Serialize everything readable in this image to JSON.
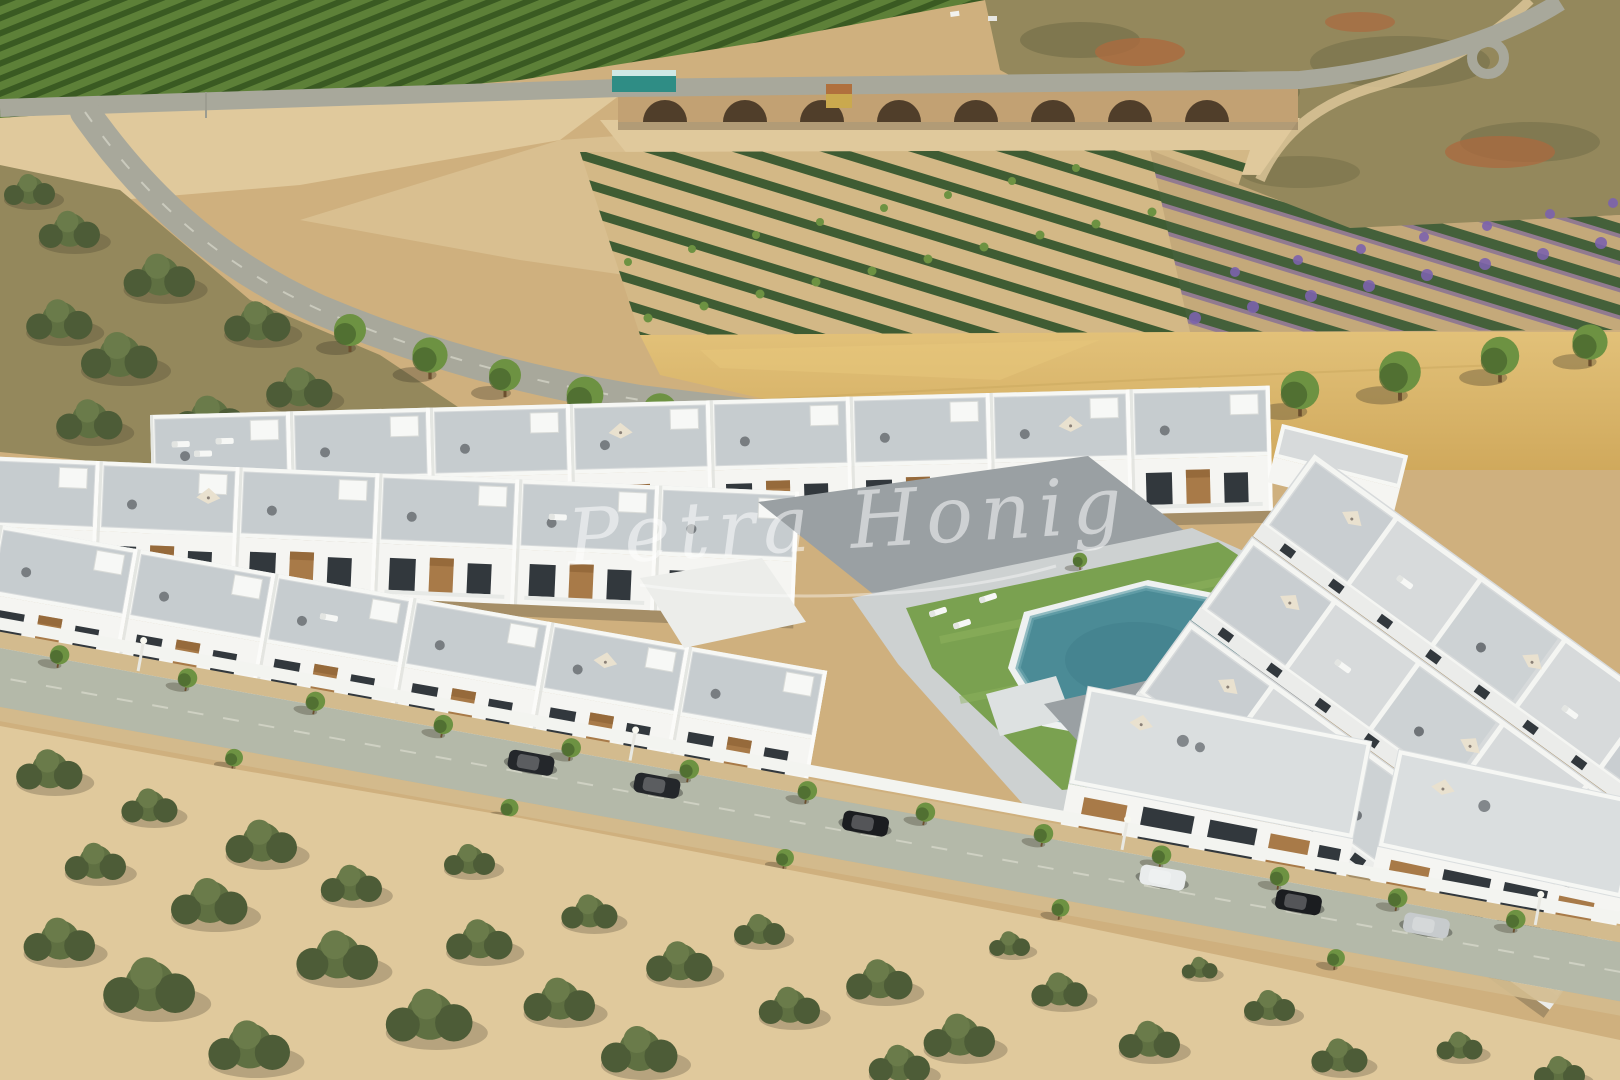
{
  "watermark": {
    "text": "Petra Honig",
    "color": "#ffffff",
    "opacity": 0.52
  },
  "palette": {
    "sand": "#cfb07e",
    "sandLight": "#e0c99c",
    "fieldGold": "#d9b469",
    "orchard": "#5d8038",
    "orchardDark": "#3a5a22",
    "scrub": "#94885c",
    "scrubDark": "#6e6a45",
    "redDirt": "#ab6a3f",
    "bushDark": "#4d5c37",
    "bushMid": "#5f7042",
    "treeGreen": "#6d9242",
    "treeDark": "#46632c",
    "road": "#a8a89b",
    "streetRoad": "#b4b9a9",
    "sidewalk": "#d3bb8e",
    "bridgeStone": "#c2a173",
    "archDark": "#503e2a",
    "plantGreen": "#3f5c33",
    "purple": "#7c63ad",
    "white": "#f5f5f2",
    "roofGray": "#d7dadb",
    "roofFloor": "#c6cccf",
    "pavingDark": "#9aa0a3",
    "wood": "#a87a48",
    "windowDark": "#32383d",
    "pool": "#4b8b96",
    "poolLight": "#6aa4ad",
    "lawn": "#7aa150",
    "lawnLight": "#8fb45e",
    "carDark": "#24272b",
    "carBlack": "#1b1d20",
    "carWhite": "#e9ecec",
    "carSilver": "#c7cbcd"
  },
  "scene": {
    "type": "aerial-architectural-render",
    "regions": [
      "orchard-rows",
      "highway-with-stone-bridge",
      "hillside-scrub",
      "plantation-rows",
      "purple-flower-rows",
      "golden-field",
      "park-tree-row",
      "residential-complex",
      "communal-pool",
      "lawn-courtyard",
      "front-street-with-parked-cars",
      "foreground-scrubland"
    ],
    "counts": {
      "parked_cars": 6,
      "pool": 1
    }
  }
}
